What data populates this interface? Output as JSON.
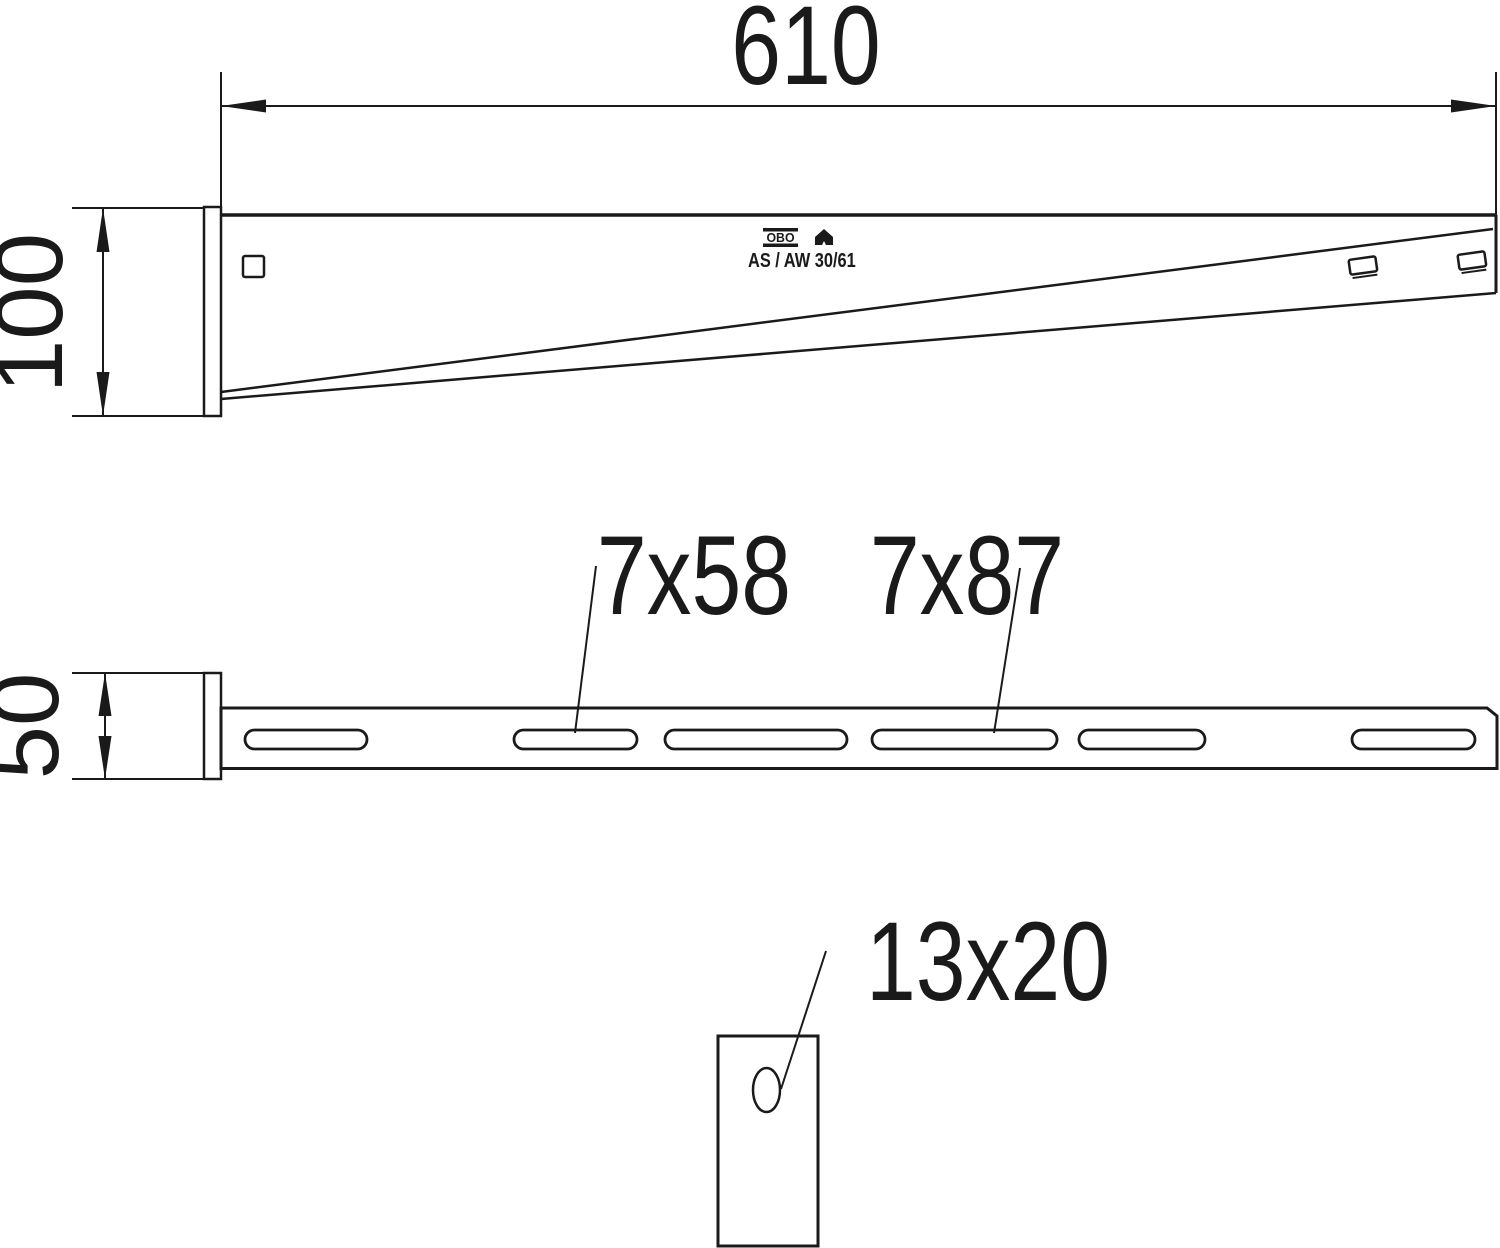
{
  "page": {
    "background": "#ffffff",
    "ink": "#1a1a1a",
    "drawing_type": "technical dimension drawing, wall and support bracket"
  },
  "side_view": {
    "length_dim": "610",
    "height_dim": "100",
    "marking": {
      "logo": "OBO",
      "product": "AS / AW 30/61"
    }
  },
  "plan_view": {
    "width_dim": "50",
    "slot_label_small": "7x58",
    "slot_label_large": "7x87"
  },
  "detail_view": {
    "hole_label": "13x20"
  }
}
